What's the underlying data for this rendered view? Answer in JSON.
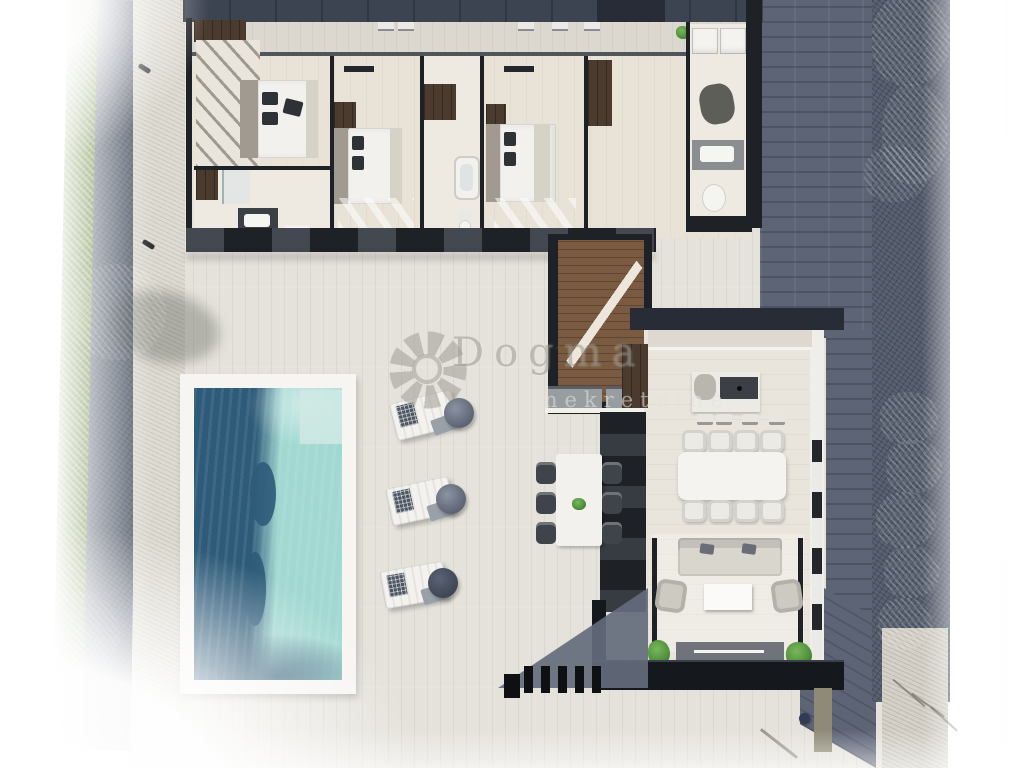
{
  "watermark": {
    "brand": "Dogma",
    "tagline": "nekretnine",
    "logo": "flower-logo"
  },
  "palette": {
    "page_bg": "#ffffff",
    "terrace": "#e5e2db",
    "walk": "#dedbd2",
    "slate": "#5d6476",
    "gravel_dark": "#515a6a",
    "gravel_light": "#d5d1c8",
    "hedge_dark": "#5c7a31",
    "tree": "#84a84e",
    "roof": "#3c4351",
    "roof_dark": "#272c37",
    "wall": "#1e2126",
    "wood_wardrobe": "#4a3b2e",
    "wood_floor": "#7a5a40",
    "floor": "#e8e2d7",
    "floor_bath": "#eeeae2",
    "bed": "#f2f1ee",
    "headboard": "#a09a90",
    "pillow": "#2e3237",
    "pool_deep": "#2e5b79",
    "pool_light": "#a2d8d2",
    "pool_pale": "#cfe9e4",
    "deck": "#f6f5f2",
    "furn_light": "#d9d6cd",
    "furn_dark": "#70747a",
    "chair_dark": "#3f444b",
    "plant": "#4e8f3a",
    "taupe": "#8f8a78",
    "navy_dot": "#2e3d55"
  },
  "scene": {
    "type": "top-down 3D architectural floor plan render of a villa",
    "rooms": [
      "bedroom-1",
      "bathroom-1",
      "bedroom-2",
      "bathroom-2",
      "bedroom-3",
      "hallway",
      "utility-wc",
      "stair-hall",
      "kitchen",
      "dining-area",
      "living-room"
    ],
    "exterior": [
      "pool",
      "pool-deck",
      "sun-loungers",
      "outdoor-dining-set",
      "terrace",
      "slate-driveway",
      "hedges",
      "trees",
      "pergola-slats"
    ],
    "counts": {
      "bedrooms": 3,
      "sun_loungers": 3,
      "indoor_dining_chairs": 8,
      "outdoor_dining_chairs": 6
    }
  }
}
